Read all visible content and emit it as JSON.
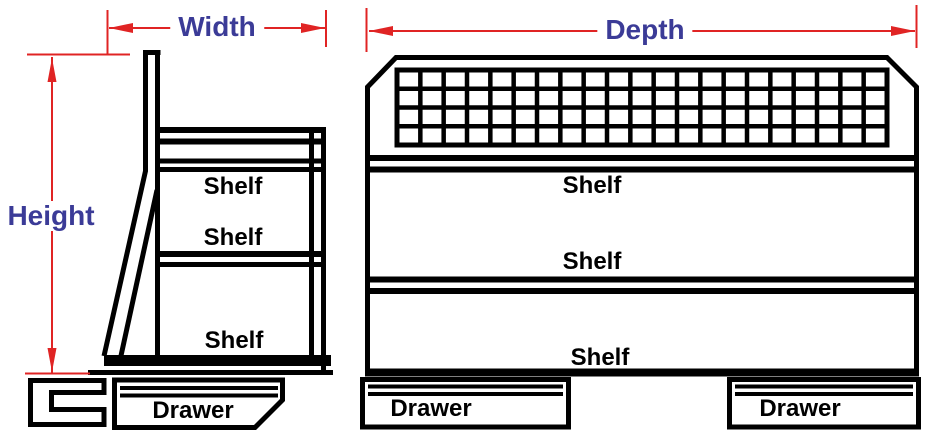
{
  "colors": {
    "line": "#000000",
    "dimension_line": "#e02424",
    "dimension_label": "#3b3b97",
    "background": "#ffffff"
  },
  "side_view": {
    "width_label": "Width",
    "height_label": "Height",
    "shelf_labels": [
      "Shelf",
      "Shelf",
      "Shelf"
    ],
    "drawer_label": "Drawer"
  },
  "front_view": {
    "depth_label": "Depth",
    "shelf_labels": [
      "Shelf",
      "Shelf",
      "Shelf"
    ],
    "drawer_labels": [
      "Drawer",
      "Drawer"
    ],
    "mesh_grid": {
      "rows": 4,
      "columns": 21
    }
  }
}
